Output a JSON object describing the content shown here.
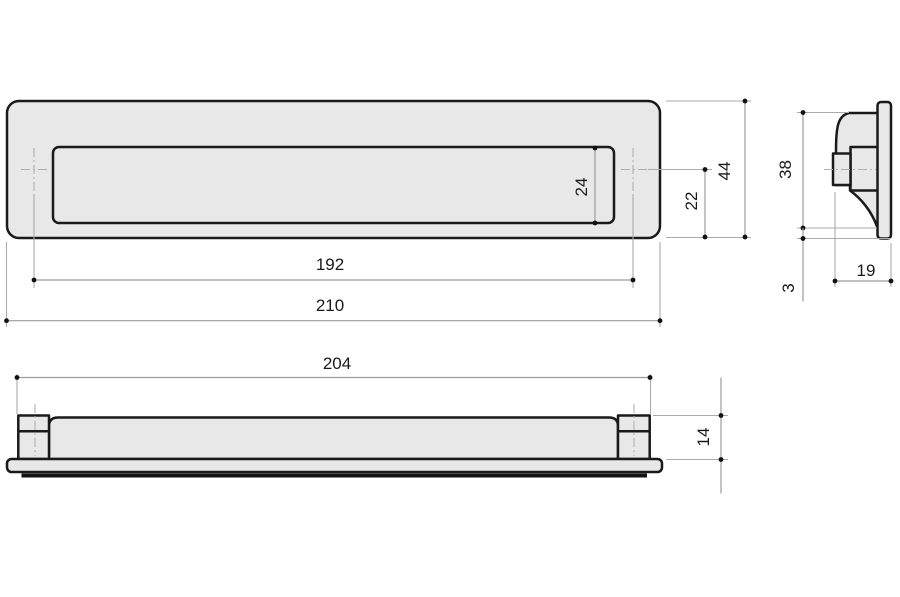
{
  "views": {
    "front": {
      "dims": {
        "overall_width": "210",
        "fixing_centers": "192",
        "height": "44",
        "flap_height": "24",
        "center_to_bottom": "22"
      }
    },
    "side": {
      "dims": {
        "body_height": "38",
        "body_depth": "19",
        "plate_lip": "3"
      }
    },
    "bottom": {
      "dims": {
        "body_width": "204",
        "depth": "14"
      }
    }
  },
  "colors": {
    "part_fill": "#e8e8e8",
    "outline": "#1a1a1a",
    "dimension_lines": "#9c9c9c",
    "dimension_text": "#1a1a1a",
    "background": "#ffffff"
  }
}
